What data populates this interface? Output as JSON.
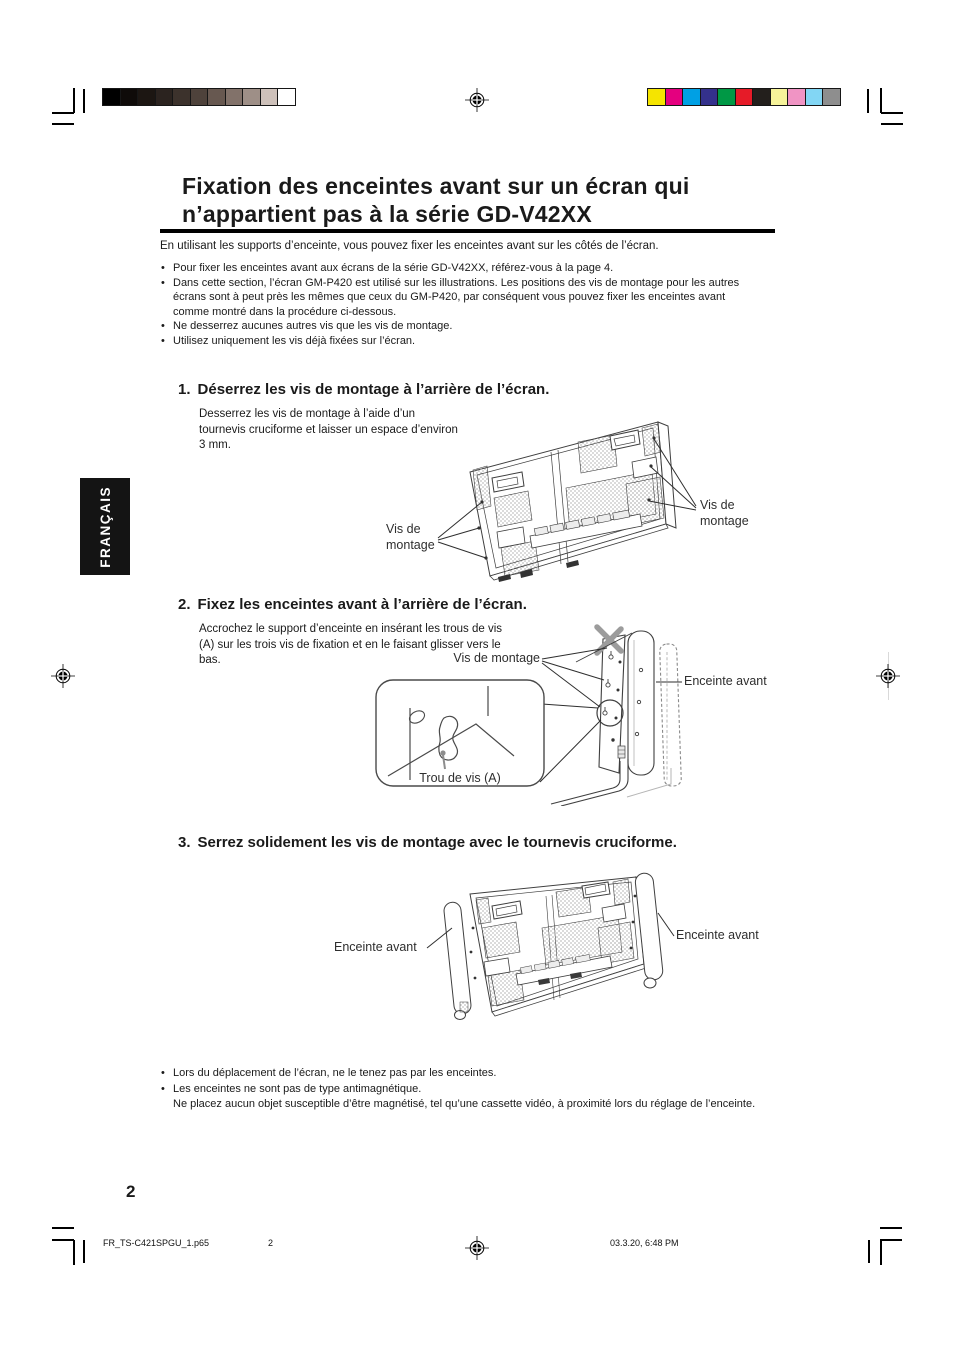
{
  "page": {
    "language_tab": "FRANÇAIS",
    "title_line1": "Fixation des enceintes avant sur un écran qui",
    "title_line2": "n’appartient pas à la série GD-V42XX",
    "intro": "En utilisant les supports d’enceinte, vous pouvez fixer les enceintes avant sur les côtés de l’écran.",
    "page_number": "2"
  },
  "chars": {
    "bullet": "•"
  },
  "notes_top": [
    "Pour fixer les enceintes avant aux écrans de la série GD-V42XX, référez-vous à la page 4.",
    "Dans cette section, l’écran GM-P420 est utilisé sur les illustrations. Les positions des vis de montage pour les autres écrans sont à peut près les mêmes que ceux du GM-P420, par conséquent vous pouvez fixer les enceintes avant comme montré dans la procédure ci-dessous.",
    "Ne desserrez aucunes autres vis que les vis de montage.",
    "Utilisez uniquement les vis déjà fixées sur l’écran."
  ],
  "steps": [
    {
      "number": "1.",
      "heading": "Déserrez les vis de montage à l’arrière de l’écran.",
      "body": "Desserrez les vis de montage à l’aide d’un tournevis cruciforme et laisser un espace d’environ 3 mm."
    },
    {
      "number": "2.",
      "heading": "Fixez les enceintes avant à l’arrière de l’écran.",
      "body": "Accrochez le support d’enceinte en insérant les trous de vis (A) sur les trois vis de fixation et en le faisant glisser vers le bas."
    },
    {
      "number": "3.",
      "heading": "Serrez solidement les vis de montage avec le tournevis cruciforme.",
      "body": ""
    }
  ],
  "figures": {
    "fig1": {
      "vis_left_1": "Vis de",
      "vis_left_2": "montage",
      "vis_right_1": "Vis de",
      "vis_right_2": "montage"
    },
    "fig2": {
      "vis": "Vis de montage",
      "enceinte": "Enceinte avant",
      "trou": "Trou de vis (A)"
    },
    "fig3": {
      "enceinte_left": "Enceinte avant",
      "enceinte_right": "Enceinte avant"
    }
  },
  "notes_bottom": [
    "Lors du déplacement de l’écran, ne le tenez pas par les enceintes.",
    "Les enceintes ne sont pas de type antimagnétique.",
    "Ne placez aucun objet susceptible d’être magnétisé, tel qu’une cassette vidéo, à proximité lors du réglage de l’enceinte."
  ],
  "footer": {
    "file": "FR_TS-C421SPGU_1.p65",
    "page": "2",
    "datetime": "03.3.20, 6:48 PM"
  },
  "print_marks": {
    "grayscale_steps": [
      "#000000",
      "#0f0b09",
      "#1c1612",
      "#2b231f",
      "#3c322c",
      "#4e423b",
      "#675850",
      "#82726a",
      "#9e8f87",
      "#cec1ba",
      "#ffffff"
    ],
    "color_steps": [
      "#f5e400",
      "#e4007f",
      "#00a0e4",
      "#34318c",
      "#009845",
      "#e61b28",
      "#231f1c",
      "#f6f39a",
      "#f094c4",
      "#82d6f4",
      "#8e8e8e"
    ]
  }
}
